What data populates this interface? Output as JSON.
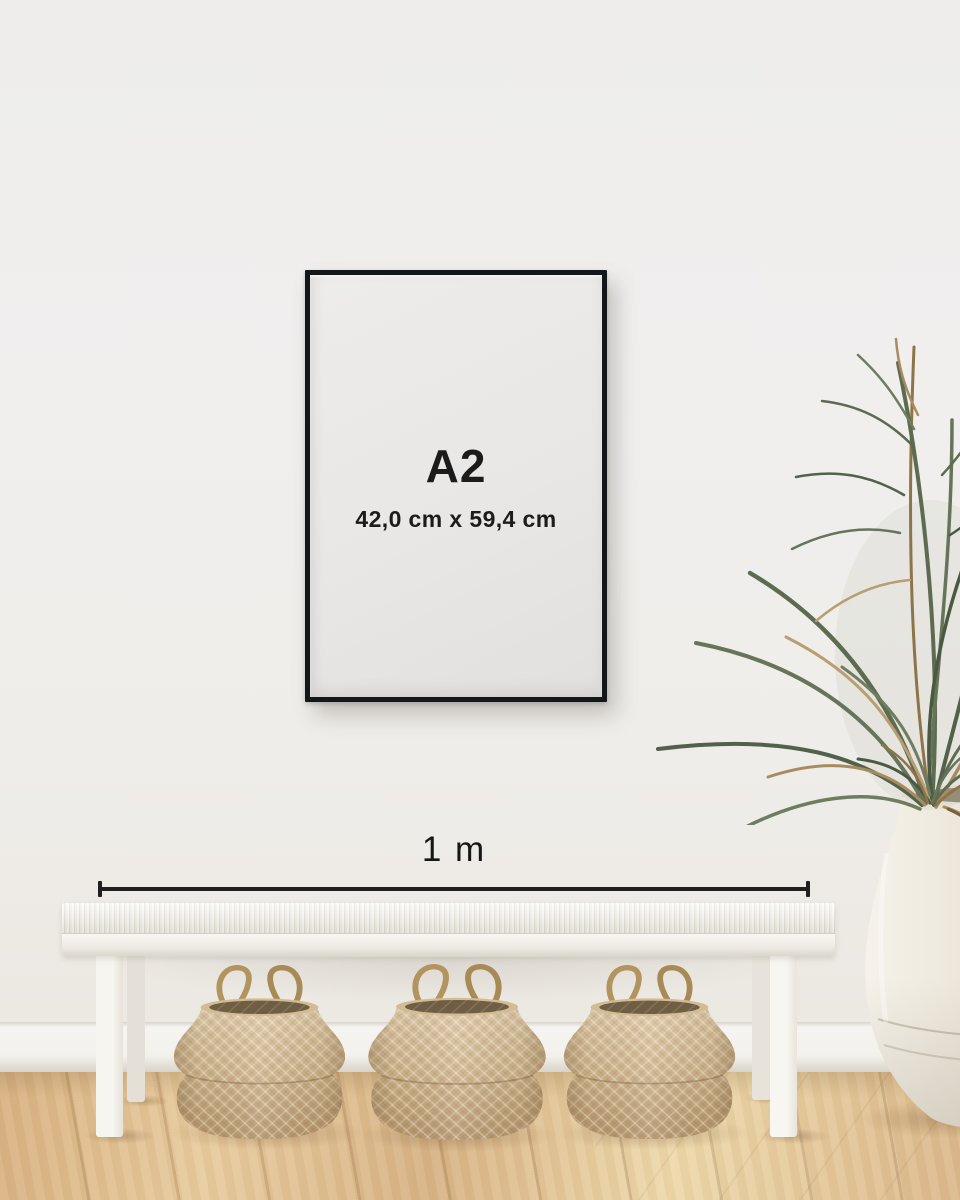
{
  "poster_frame": {
    "size_label": "A2",
    "dimensions_label": "42,0 cm x 59,4 cm"
  },
  "measurement": {
    "label": "1 m"
  },
  "colors": {
    "frame": "#14171a",
    "poster_background": "#e9e7e5",
    "label_text": "#1b1b1b",
    "measure_line": "#1f201f",
    "wall": "#efeeec",
    "baseboard": "#f3f1ec",
    "floor_wood": "#ddbb8e",
    "bench_white": "#f3f0ea",
    "basket_tan": "#c9ab7f",
    "plant_green": "#5d6b50",
    "plant_brown": "#a98c5e",
    "vase_white": "#ebe5d8"
  }
}
